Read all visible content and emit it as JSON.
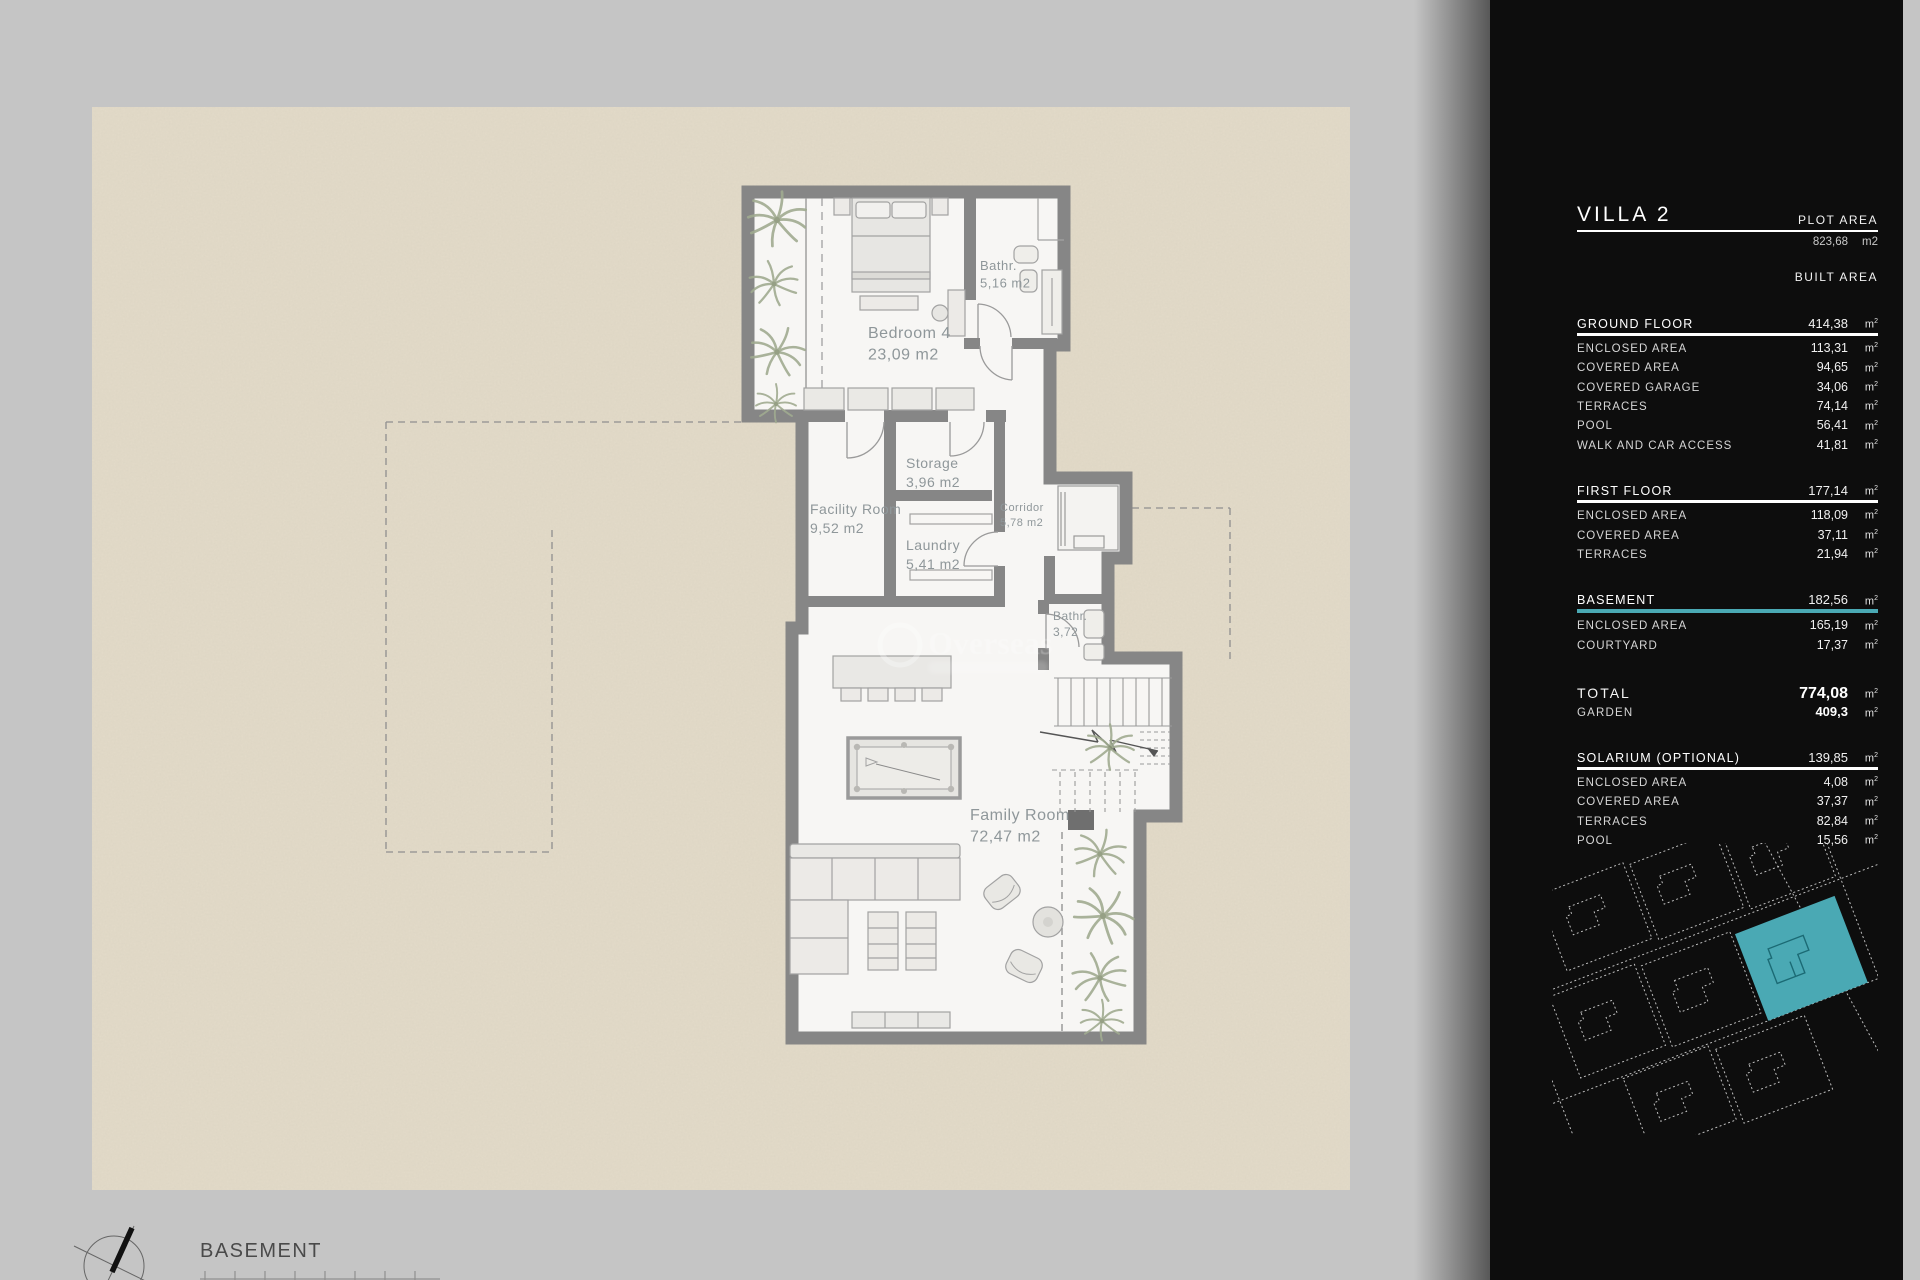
{
  "plan": {
    "basement_title": "BASEMENT",
    "watermark": "Overseas",
    "wall_color": "#868686",
    "floor_color": "#f7f6f4",
    "terrain_color": "#e3dbc9",
    "rooms": [
      {
        "label": "Bedroom 4",
        "area": "23,09 m2",
        "x": 868,
        "y": 338,
        "size": 16
      },
      {
        "label": "Bathr.",
        "area": "5,16 m2",
        "x": 980,
        "y": 270,
        "size": 13
      },
      {
        "label": "Storage",
        "area": "3,96 m2",
        "x": 906,
        "y": 468,
        "size": 14
      },
      {
        "label": "Facility Room",
        "area": "9,52 m2",
        "x": 810,
        "y": 514,
        "size": 14
      },
      {
        "label": "Laundry",
        "area": "5,41 m2",
        "x": 906,
        "y": 550,
        "size": 14
      },
      {
        "label": "Corridor",
        "area": "5,78 m2",
        "x": 1000,
        "y": 511,
        "size": 11
      },
      {
        "label": "Bathr.",
        "area": "3,72",
        "x": 1053,
        "y": 620,
        "size": 12
      },
      {
        "label": "Family Room",
        "area": "72,47 m2",
        "x": 970,
        "y": 820,
        "size": 16
      }
    ]
  },
  "sidebar": {
    "accent": "#4aa9b4",
    "title": "VILLA 2",
    "plot_area_label": "PLOT AREA",
    "plot_area_value": "823,68",
    "plot_area_unit": "m2",
    "built_area_label": "BUILT AREA",
    "unit": "m2",
    "sections": [
      {
        "name": "GROUND FLOOR",
        "value": "414,38",
        "highlight": false,
        "rows": [
          {
            "label": "ENCLOSED AREA",
            "value": "113,31"
          },
          {
            "label": "COVERED AREA",
            "value": "94,65"
          },
          {
            "label": "COVERED GARAGE",
            "value": "34,06"
          },
          {
            "label": "TERRACES",
            "value": "74,14"
          },
          {
            "label": "POOL",
            "value": "56,41"
          },
          {
            "label": "WALK AND CAR ACCESS",
            "value": "41,81"
          }
        ]
      },
      {
        "name": "FIRST FLOOR",
        "value": "177,14",
        "highlight": false,
        "rows": [
          {
            "label": "ENCLOSED AREA",
            "value": "118,09"
          },
          {
            "label": "COVERED AREA",
            "value": "37,11"
          },
          {
            "label": "TERRACES",
            "value": "21,94"
          }
        ]
      },
      {
        "name": "BASEMENT",
        "value": "182,56",
        "highlight": true,
        "rows": [
          {
            "label": "ENCLOSED AREA",
            "value": "165,19"
          },
          {
            "label": "COURTYARD",
            "value": "17,37"
          }
        ]
      }
    ],
    "total_label": "TOTAL",
    "total_value": "774,08",
    "garden_label": "GARDEN",
    "garden_value": "409,3",
    "solarium": {
      "name": "SOLARIUM (OPTIONAL)",
      "value": "139,85",
      "highlight": false,
      "rows": [
        {
          "label": "ENCLOSED AREA",
          "value": "4,08"
        },
        {
          "label": "COVERED AREA",
          "value": "37,37"
        },
        {
          "label": "TERRACES",
          "value": "82,84"
        },
        {
          "label": "POOL",
          "value": "15,56"
        }
      ]
    }
  }
}
